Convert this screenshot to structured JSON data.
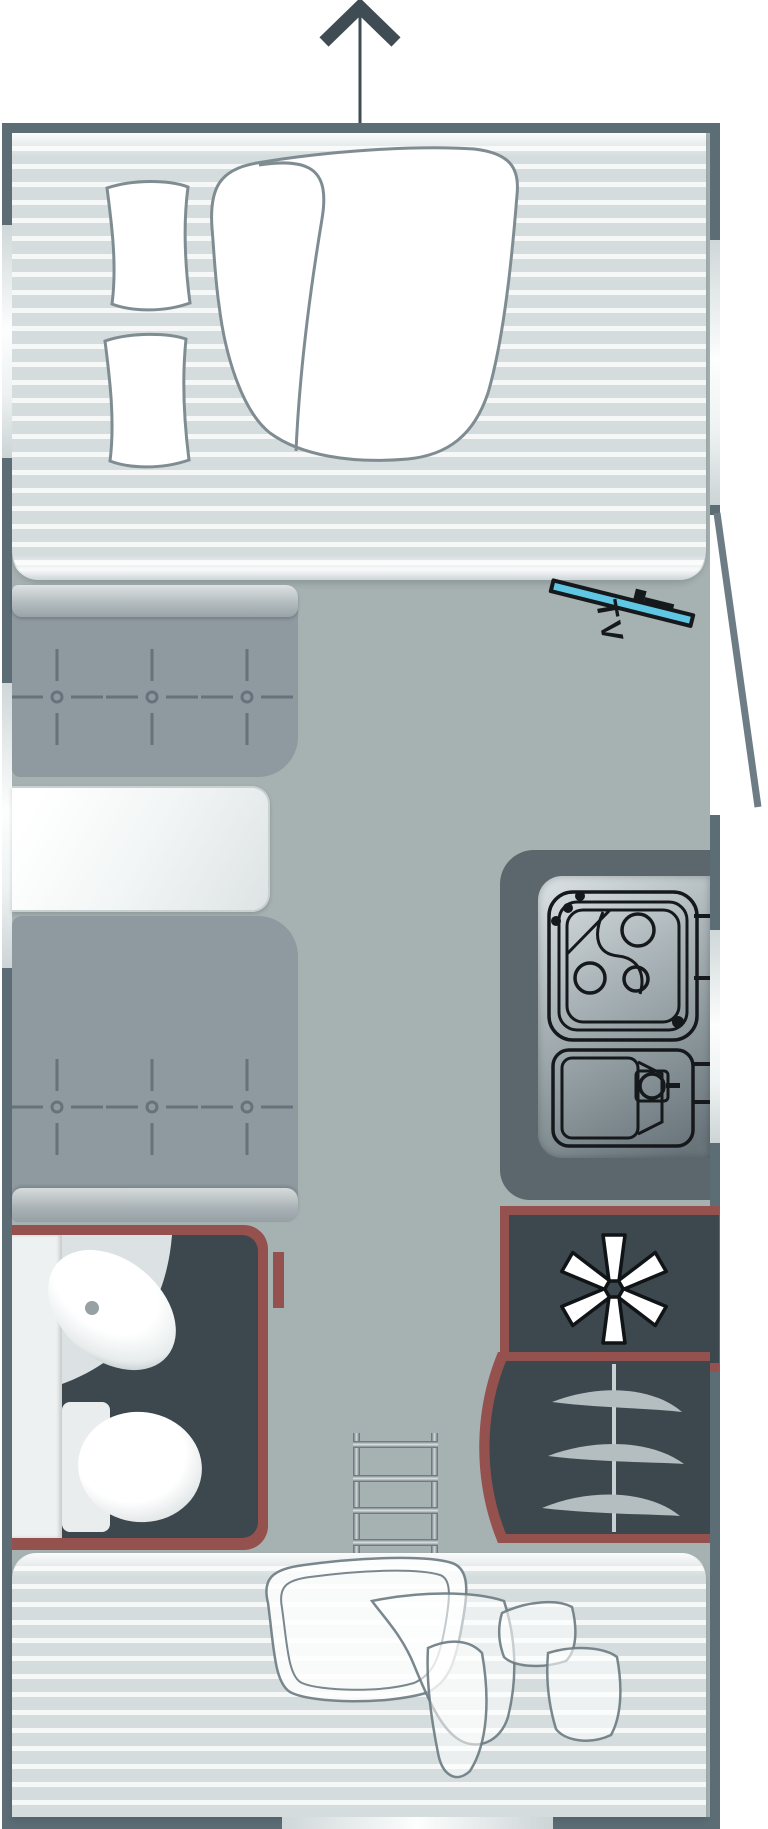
{
  "meta": {
    "title": "Caravan floor plan",
    "view": "top-down"
  },
  "labels": {
    "tv": "TV"
  },
  "theme": {
    "colors": {
      "wall": "#5c6d76",
      "floor": "#a6b1b1",
      "mattress": "#d4dcdd",
      "mattressStripe": "#f6f8f8",
      "beddingOutline": "#7f8d93",
      "bench": "#8f9aa0",
      "benchHighlight": "#dde2e3",
      "tuft": "#66737a",
      "table": "#f3f6f6",
      "counter": "#5b676d",
      "steel": "#aeb8bc",
      "dark": "#3c484e",
      "maroon": "#94514e",
      "cyan": "#5fc6e3",
      "black": "#15191b",
      "hanger": "#b4bdc0",
      "arrow": "#3f4c54",
      "window": "#fdfefe"
    }
  },
  "features": [
    {
      "id": "direction-arrow",
      "icon": "arrow-up-icon"
    },
    {
      "id": "front-bed",
      "icon": "bed-duvet-pillows-icon"
    },
    {
      "id": "tv-mount",
      "label": "TV"
    },
    {
      "id": "entry-door",
      "icon": "door-swing-icon"
    },
    {
      "id": "dinette",
      "icon": "two-benches-table-icon"
    },
    {
      "id": "kitchen",
      "icon": "hob-and-sink-icon"
    },
    {
      "id": "fridge",
      "icon": "snowflake-asterisk-icon"
    },
    {
      "id": "wardrobe",
      "icon": "clothes-hangers-icon"
    },
    {
      "id": "bathroom",
      "icon": "washbasin-toilet-icon"
    },
    {
      "id": "bunk-ladder",
      "icon": "ladder-icon"
    },
    {
      "id": "rear-bed",
      "icon": "bed-duvet-pillows-icon"
    },
    {
      "id": "windows",
      "icon": "window-opening-icon"
    }
  ]
}
